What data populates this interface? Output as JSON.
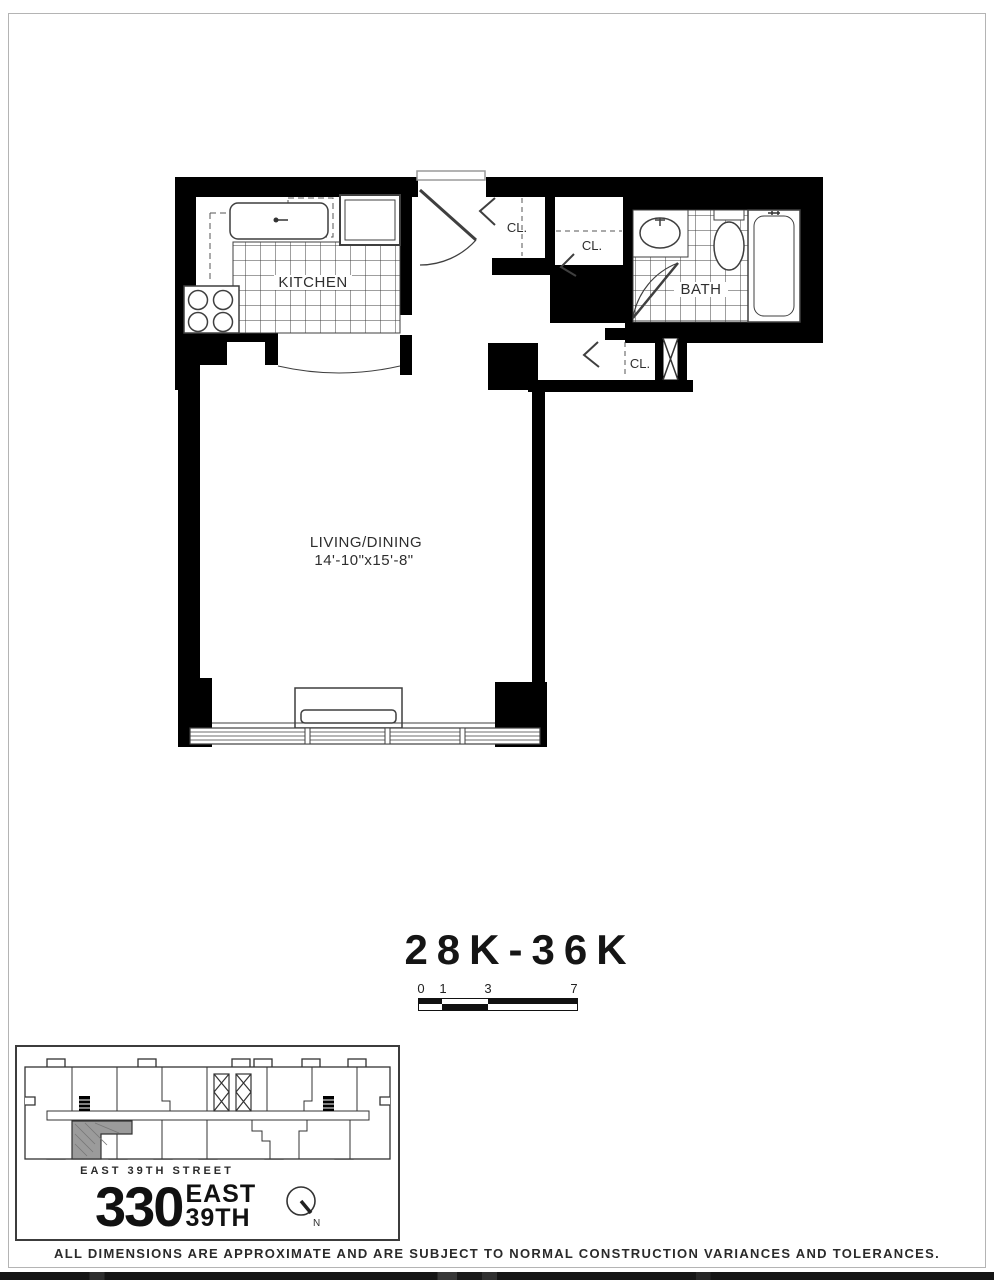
{
  "unit": {
    "label": "28K-36K"
  },
  "floorplan": {
    "kitchen_label": "KITCHEN",
    "bath_label": "BATH",
    "living_label": "LIVING/DINING",
    "living_dims": "14'-10\"x15'-8\"",
    "closets": [
      "CL.",
      "CL.",
      "CL."
    ]
  },
  "scale_bar": {
    "ticks": [
      "0",
      "1",
      "3",
      "7"
    ]
  },
  "key_plan": {
    "street": "EAST 39TH STREET"
  },
  "logo": {
    "number": "330",
    "word1": "EAST",
    "word2": "39TH",
    "north": "N"
  },
  "disclaimer": "ALL DIMENSIONS ARE APPROXIMATE AND ARE SUBJECT TO NORMAL CONSTRUCTION VARIANCES AND TOLERANCES.",
  "colors": {
    "wall": "#000000",
    "line": "#3f3f3f",
    "unit_highlight": "#9b9b9b"
  }
}
